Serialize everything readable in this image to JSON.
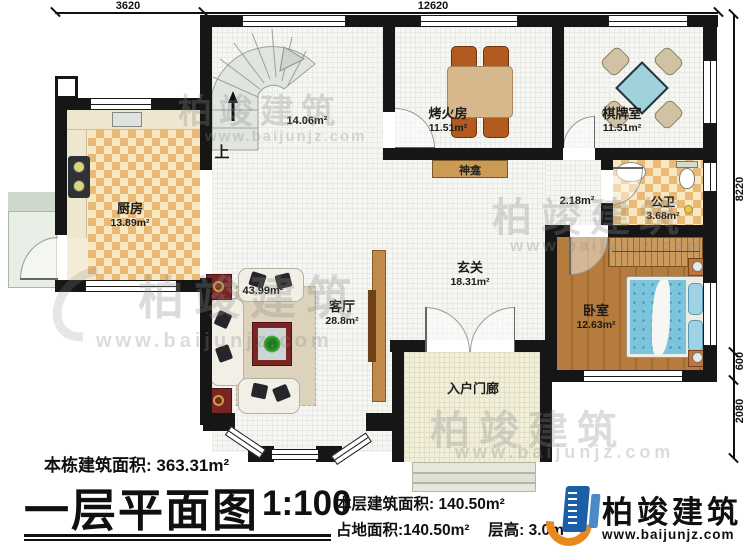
{
  "watermark": {
    "text": "柏竣建筑",
    "url": "www.baijunjz.com"
  },
  "dims": {
    "top1": "3620",
    "top2": "12620",
    "right1": "8220",
    "right2": "600",
    "right3": "2080"
  },
  "rooms": {
    "kitchen": {
      "name": "厨房",
      "area": "13.89m²"
    },
    "stairwell": {
      "up": "上",
      "area": "14.06m²"
    },
    "fire_room": {
      "name": "烤火房",
      "area": "11.51m²"
    },
    "chess_room": {
      "name": "棋牌室",
      "area": "11.51m²"
    },
    "shrine": {
      "name": "神龛"
    },
    "corridor": {
      "area": "2.18m²"
    },
    "bathroom": {
      "name": "公卫",
      "area": "3.68m²"
    },
    "hallway": {
      "name": "玄关",
      "area": "18.31m²"
    },
    "living_room": {
      "name": "客厅",
      "area": "28.8m²",
      "combined_area": "43.99m²"
    },
    "bedroom": {
      "name": "卧室",
      "area": "12.63m²"
    },
    "porch": {
      "name": "入户门廊"
    }
  },
  "footer": {
    "total_building_area": "本栋建筑面积: 363.31m²",
    "title": "一层平面图",
    "scale": "1:100",
    "floor_area": "本层建筑面积: 140.50m²",
    "ground_area": "占地面积:140.50m²",
    "floor_height": "层高: 3.0m",
    "brand": {
      "name": "柏竣建筑",
      "url": "www.baijunjz.com"
    }
  }
}
